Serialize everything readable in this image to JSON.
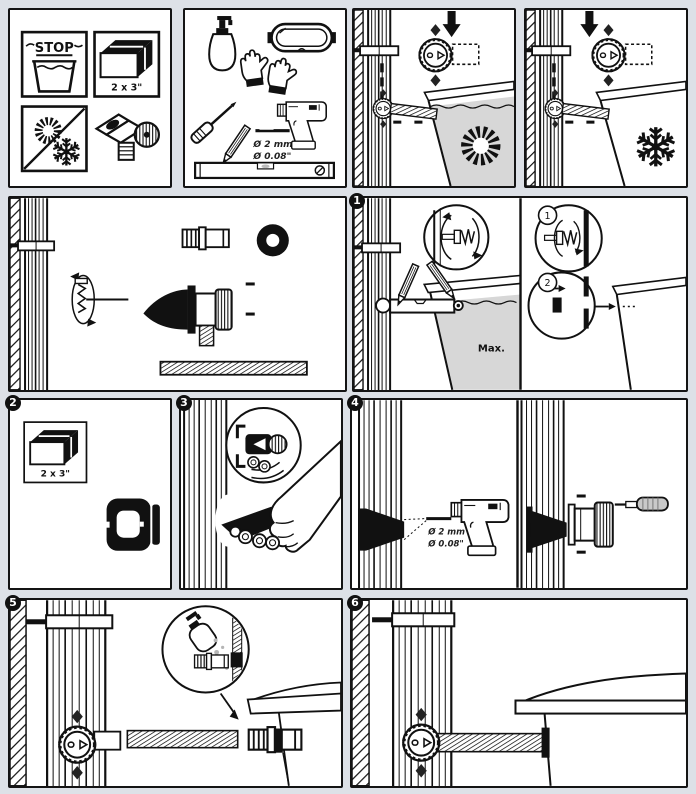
{
  "document": {
    "kind": "rain-barrel-faucet-installation-instructions",
    "background_color": "#dde1e7",
    "line_color": "#111111",
    "water_gray": "#d7d7d7"
  },
  "warnings_panel": {
    "stop_label": "STOP",
    "lumber_size_label": "2 x 3\"",
    "icons": [
      "stop-water-icon",
      "lumber-icon",
      "no-sun-frost-icon",
      "faucet-device-icon"
    ]
  },
  "tools_panel": {
    "drill_bit_label_metric": "Ø 2 mm",
    "drill_bit_label_imperial": "Ø 0.08\"",
    "icons": [
      "soap-bottle-icon",
      "goggles-icon",
      "gloves-icon",
      "screwdriver-icon",
      "pencil-icon",
      "drill-bit-icon",
      "drill-icon",
      "spirit-level-icon"
    ]
  },
  "usage_panels": {
    "summer_icon": "sun-icon",
    "winter_icon": "snowflake-icon"
  },
  "step_panels": {
    "step1": {
      "badge": "1",
      "max_water_label": "Max.",
      "detail_markers": [
        "1",
        "2"
      ]
    },
    "step2": {
      "badge": "2",
      "lumber_size_label": "2 x 3\""
    },
    "step3": {
      "badge": "3"
    },
    "step4": {
      "badge": "4",
      "drill_bit_label_metric": "Ø 2 mm",
      "drill_bit_label_imperial": "Ø 0.08\""
    },
    "step5": {
      "badge": "5"
    },
    "step6": {
      "badge": "6"
    }
  }
}
